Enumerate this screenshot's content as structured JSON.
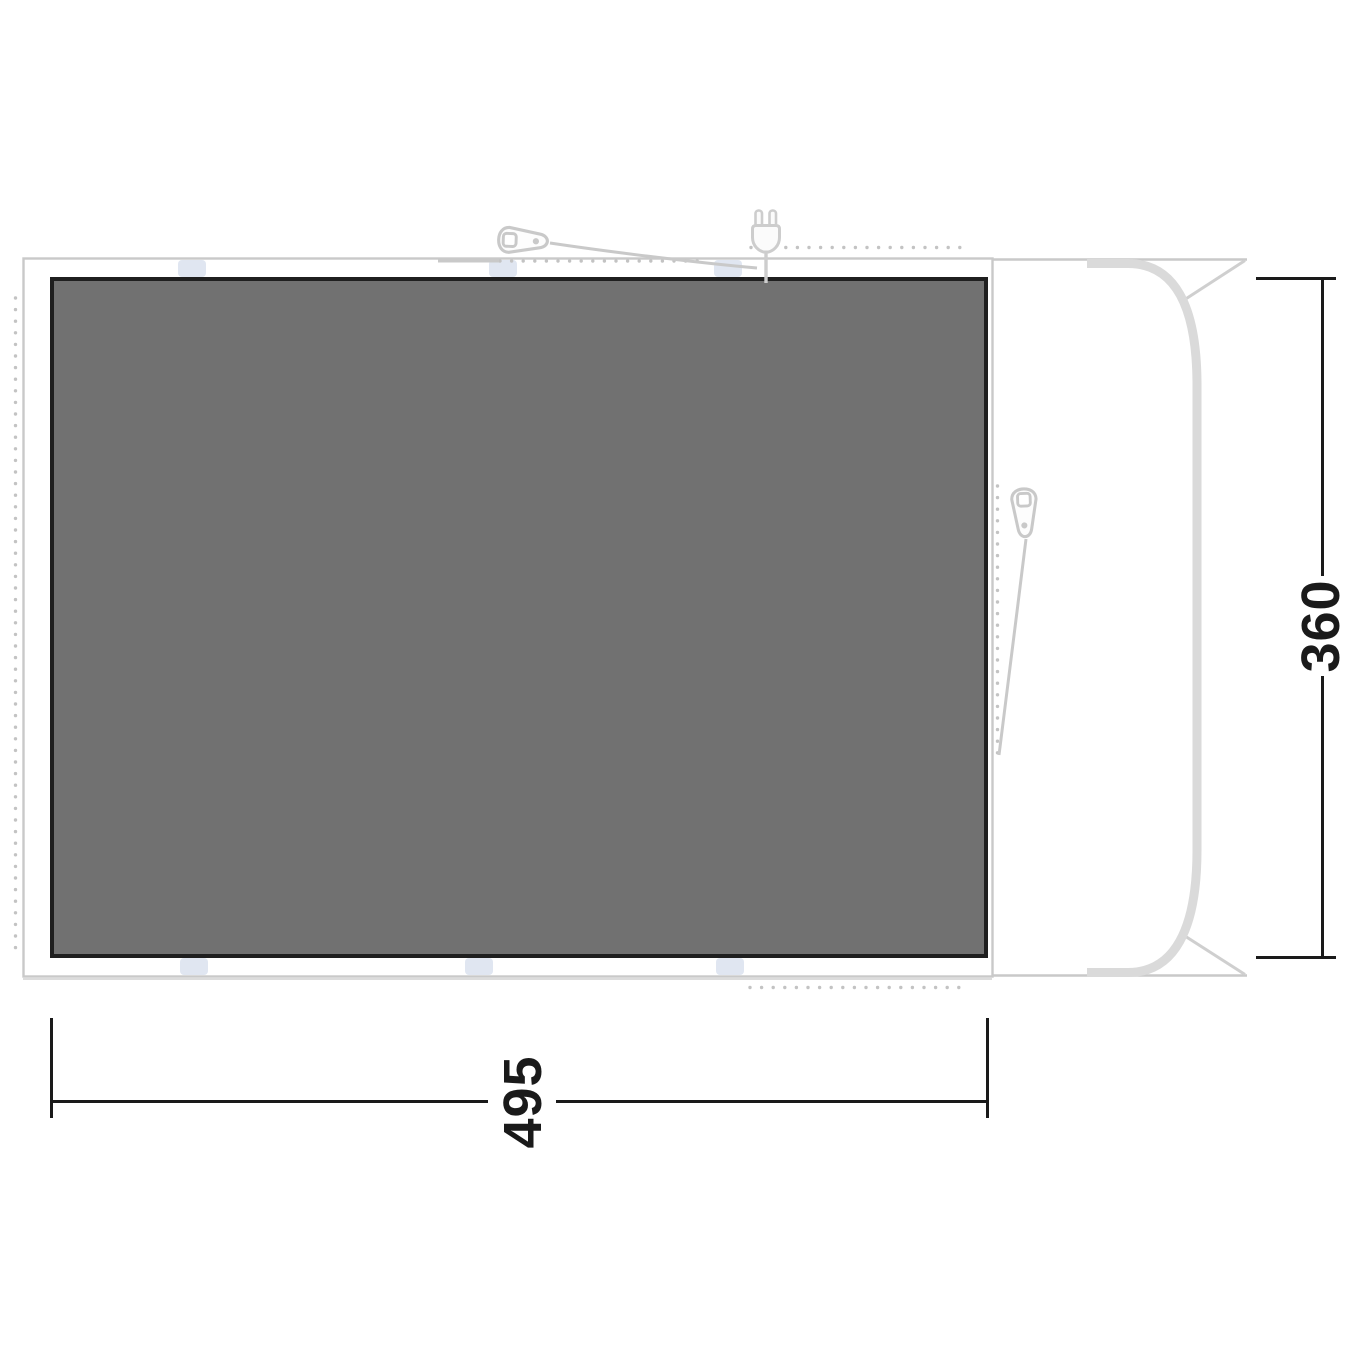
{
  "diagram": {
    "type": "awning-footprint-floorplan",
    "dimensions": {
      "width_label": "495",
      "height_label": "360"
    },
    "icons": [
      "zipper-pull-icon",
      "power-plug-icon",
      "vehicle-silhouette",
      "attachment-tab",
      "dotted-zip-line"
    ],
    "colors": {
      "background": "#ffffff",
      "groundsheet_fill": "#717171",
      "groundsheet_border": "#1f1f1f",
      "outline_gray": "#c9c9c9",
      "light_band_gray": "#dadada",
      "dot_gray": "#c3c3c3",
      "tab_blue": "#e0e6f1",
      "dimension_black": "#1a1a1a"
    }
  }
}
